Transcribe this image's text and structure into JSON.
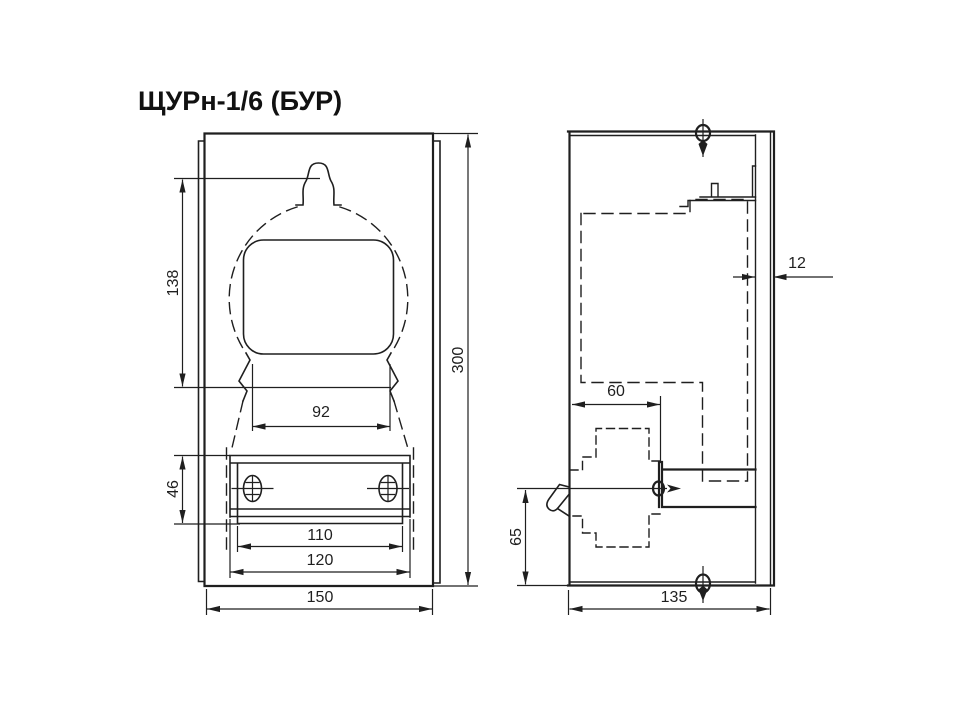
{
  "title": "ЩУРн-1/6 (БУР)",
  "front_view": {
    "dims": {
      "h138": "138",
      "w92": "92",
      "h46": "46",
      "w110": "110",
      "w120": "120",
      "w150": "150",
      "h300": "300"
    }
  },
  "side_view": {
    "dims": {
      "g12": "12",
      "d60": "60",
      "h65": "65",
      "d135": "135"
    }
  }
}
